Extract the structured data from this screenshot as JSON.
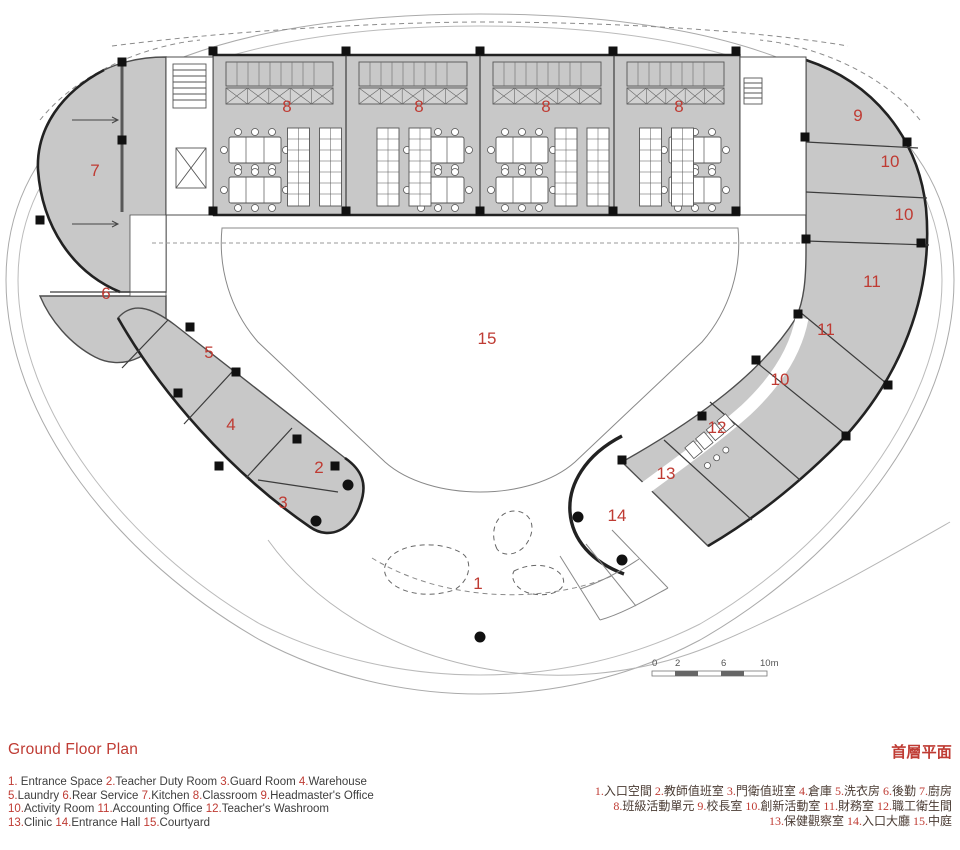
{
  "title": {
    "en": "Ground Floor Plan",
    "zh": "首層平面"
  },
  "colors": {
    "accent_red": "#bf3b33",
    "room_fill": "#c8c8c8",
    "wall": "#1f1f1f",
    "text": "#3d3d3d"
  },
  "legend": {
    "en_lines": [
      [
        {
          "n": "1",
          "t": " Entrance Space"
        },
        {
          "n": "2",
          "t": "Teacher Duty Room"
        },
        {
          "n": "3",
          "t": "Guard Room"
        },
        {
          "n": "4",
          "t": "Warehouse"
        }
      ],
      [
        {
          "n": "5",
          "t": "Laundry"
        },
        {
          "n": "6",
          "t": "Rear Service"
        },
        {
          "n": "7",
          "t": "Kitchen"
        },
        {
          "n": "8",
          "t": "Classroom"
        },
        {
          "n": "9",
          "t": "Headmaster's Office"
        }
      ],
      [
        {
          "n": "10",
          "t": "Activity Room"
        },
        {
          "n": "11",
          "t": "Accounting Office"
        },
        {
          "n": "12",
          "t": "Teacher's  Washroom"
        }
      ],
      [
        {
          "n": "13",
          "t": "Clinic"
        },
        {
          "n": "14",
          "t": "Entrance Hall"
        },
        {
          "n": "15",
          "t": "Courtyard"
        }
      ]
    ],
    "zh_lines": [
      [
        {
          "n": "1",
          "t": "入口空間"
        },
        {
          "n": "2",
          "t": "教師值班室"
        },
        {
          "n": "3",
          "t": "門衛值班室"
        },
        {
          "n": "4",
          "t": "倉庫"
        },
        {
          "n": "5",
          "t": "洗衣房"
        },
        {
          "n": "6",
          "t": "後勤"
        },
        {
          "n": "7",
          "t": "廚房"
        }
      ],
      [
        {
          "n": "8",
          "t": "班級活動單元"
        },
        {
          "n": "9",
          "t": "校長室"
        },
        {
          "n": "10",
          "t": "創新活動室"
        },
        {
          "n": "11",
          "t": "財務室"
        },
        {
          "n": "12",
          "t": "職工衛生間"
        }
      ],
      [
        {
          "n": "13",
          "t": "保健觀察室"
        },
        {
          "n": "14",
          "t": "入口大廳"
        },
        {
          "n": "15",
          "t": "中庭"
        }
      ]
    ]
  },
  "plan": {
    "rooms": [
      {
        "n": "8",
        "x": 287,
        "y": 112
      },
      {
        "n": "8",
        "x": 419,
        "y": 112
      },
      {
        "n": "8",
        "x": 546,
        "y": 112
      },
      {
        "n": "8",
        "x": 679,
        "y": 112
      },
      {
        "n": "7",
        "x": 95,
        "y": 176
      },
      {
        "n": "9",
        "x": 858,
        "y": 121
      },
      {
        "n": "10",
        "x": 890,
        "y": 167
      },
      {
        "n": "10",
        "x": 904,
        "y": 220
      },
      {
        "n": "11",
        "x": 872,
        "y": 287
      },
      {
        "n": "11",
        "x": 826,
        "y": 335
      },
      {
        "n": "6",
        "x": 106,
        "y": 299
      },
      {
        "n": "5",
        "x": 209,
        "y": 358
      },
      {
        "n": "15",
        "x": 487,
        "y": 344
      },
      {
        "n": "10",
        "x": 780,
        "y": 385
      },
      {
        "n": "4",
        "x": 231,
        "y": 430
      },
      {
        "n": "12",
        "x": 717,
        "y": 433
      },
      {
        "n": "2",
        "x": 319,
        "y": 473
      },
      {
        "n": "13",
        "x": 666,
        "y": 479
      },
      {
        "n": "3",
        "x": 283,
        "y": 508
      },
      {
        "n": "14",
        "x": 617,
        "y": 521
      },
      {
        "n": "1",
        "x": 478,
        "y": 589
      }
    ],
    "scale": {
      "labels": [
        "0",
        "2",
        "6",
        "10m"
      ]
    }
  }
}
